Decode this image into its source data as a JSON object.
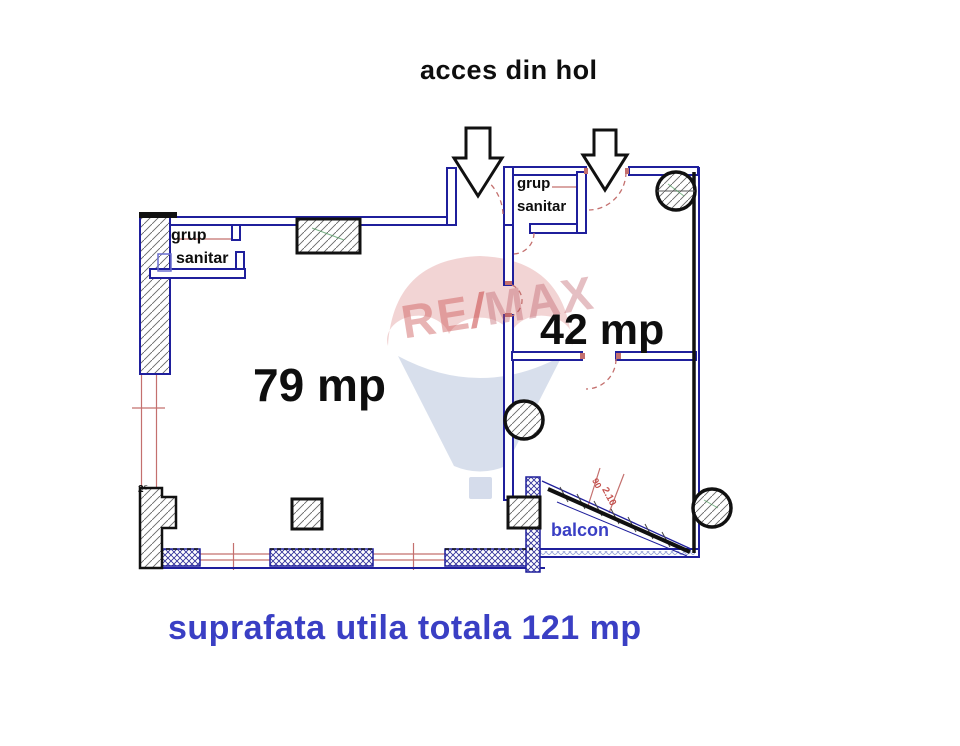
{
  "title": "acces din hol",
  "footer": "suprafata utila totala 121 mp",
  "watermark": {
    "re": "RE",
    "slash": "/",
    "max": "MAX"
  },
  "rooms": {
    "living": "79 mp",
    "secondary": "42 mp",
    "bath_left_line1": "grup",
    "bath_left_line2": "sanitar",
    "bath_right_line1": "grup",
    "bath_right_line2": "sanitar",
    "balcony": "balcon"
  },
  "dimensions": {
    "door_width": "90",
    "door_height": "2.10",
    "wall_mark": "2⁵"
  },
  "colors": {
    "wall_blue": "#1f1f9c",
    "dim_red": "#c4706e",
    "outline_black": "#111111",
    "label_blue": "#3a3fc4"
  }
}
